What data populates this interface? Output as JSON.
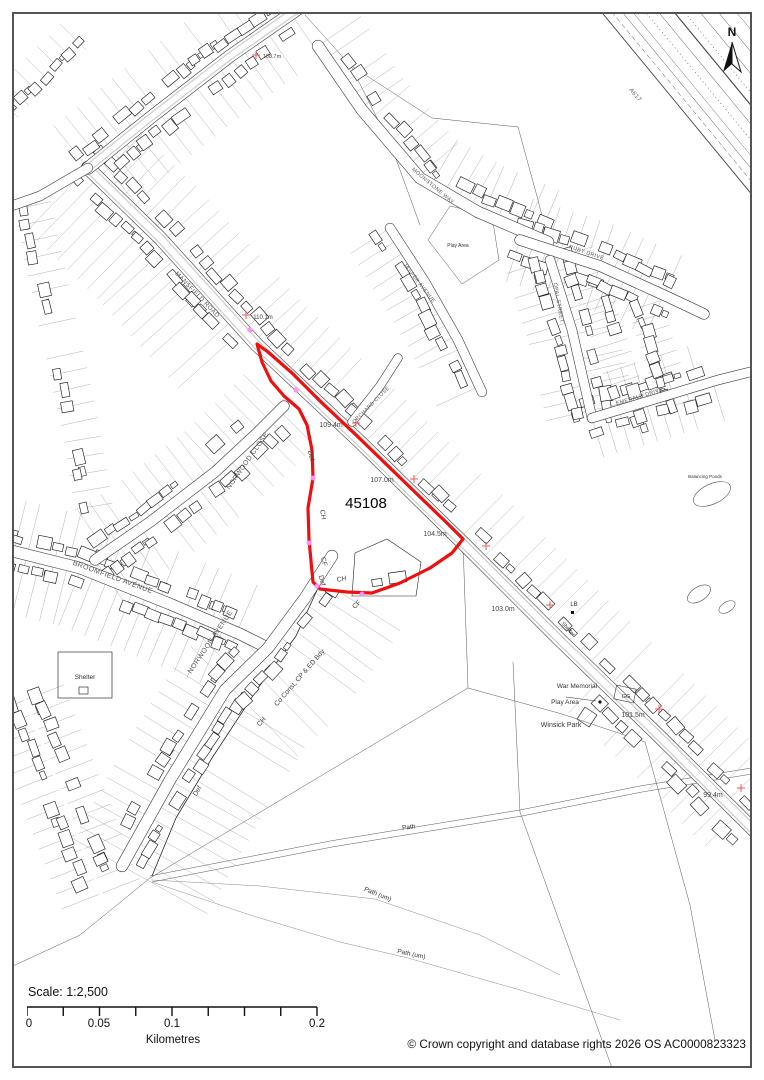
{
  "page": {
    "background": "#ffffff",
    "border_color": "#545456"
  },
  "compass": {
    "north_label": "N"
  },
  "site": {
    "ref_label": "45108",
    "boundary_color": "#ee0f0f"
  },
  "scalebar": {
    "scale_label": "Scale: 1:2,500",
    "tick_labels": [
      "0",
      "0.05",
      "0.1",
      "0.2"
    ],
    "unit_label": "Kilometres"
  },
  "footer": {
    "copyright": "© Crown copyright and database rights 2026 OS AC0000823323"
  },
  "colors": {
    "elevation_cross": "#ea5c5c",
    "boundary_marker": "#ff70ff",
    "street_text": "#555555",
    "feature_text": "#333333"
  },
  "labels": {
    "streets": [
      {
        "text": "MANSFIELD ROAD",
        "x": 196,
        "y": 296,
        "rot": 46,
        "size": 6.2
      },
      {
        "text": "ORCHARD CLOSE",
        "x": 372,
        "y": 406,
        "rot": -45,
        "size": 5.2
      },
      {
        "text": "NORWOOD CLOSE",
        "x": 249,
        "y": 462,
        "rot": -55,
        "size": 6.8
      },
      {
        "text": "BROOMFIELD AVENUE",
        "x": 112,
        "y": 579,
        "rot": 20,
        "size": 7
      },
      {
        "text": "NORWOOD AVENUE",
        "x": 212,
        "y": 643,
        "rot": -56,
        "size": 7
      },
      {
        "text": "MOONSTONE WAY",
        "x": 432,
        "y": 187,
        "rot": 40,
        "size": 5.4
      },
      {
        "text": "JASPER AVENUE",
        "x": 418,
        "y": 284,
        "rot": 52,
        "size": 5.4
      },
      {
        "text": "RUBY DRIVE",
        "x": 586,
        "y": 254,
        "rot": 19,
        "size": 5.4
      },
      {
        "text": "OPAL STREET",
        "x": 557,
        "y": 303,
        "rot": 80,
        "size": 5.4
      },
      {
        "text": "EMERALD DRIVE",
        "x": 640,
        "y": 398,
        "rot": -17,
        "size": 5.4
      },
      {
        "text": "A617",
        "x": 634,
        "y": 96,
        "rot": 50,
        "size": 6
      }
    ],
    "boundaries": [
      {
        "text": "Def",
        "x": 309,
        "y": 456,
        "rot": 78
      },
      {
        "text": "CH",
        "x": 321,
        "y": 515,
        "rot": 80
      },
      {
        "text": "CF",
        "x": 322,
        "y": 562,
        "rot": 75
      },
      {
        "text": "Def",
        "x": 320,
        "y": 581,
        "rot": 75
      },
      {
        "text": "CH",
        "x": 342,
        "y": 581,
        "rot": -10
      },
      {
        "text": "CF",
        "x": 358,
        "y": 606,
        "rot": -44
      },
      {
        "text": "Co Const, CP & ED Bdy",
        "x": 301,
        "y": 679,
        "rot": -49
      },
      {
        "text": "CH",
        "x": 263,
        "y": 723,
        "rot": -49
      },
      {
        "text": "Def",
        "x": 199,
        "y": 792,
        "rot": -58
      }
    ],
    "elevations": [
      {
        "text": "108.7m",
        "x": 272,
        "y": 58,
        "cx": 256,
        "cy": 55,
        "size": 5.5
      },
      {
        "text": "110.1m",
        "x": 263,
        "y": 319,
        "cx": 246,
        "cy": 315,
        "size": 6
      },
      {
        "text": "109.4m",
        "x": 331,
        "y": 427,
        "cx": 356,
        "cy": 423,
        "size": 7
      },
      {
        "text": "107.0m",
        "x": 382,
        "y": 482,
        "cx": 414,
        "cy": 479,
        "size": 7
      },
      {
        "text": "104.5m",
        "x": 435,
        "y": 536,
        "cx": 486,
        "cy": 546,
        "size": 7
      },
      {
        "text": "103.0m",
        "x": 503,
        "y": 611,
        "cx": 550,
        "cy": 605,
        "size": 7
      },
      {
        "text": "101.5m",
        "x": 633,
        "y": 717,
        "cx": 659,
        "cy": 709,
        "size": 7
      },
      {
        "text": "99.4m",
        "x": 713,
        "y": 797,
        "cx": 741,
        "cy": 788,
        "size": 7
      }
    ],
    "features": [
      {
        "text": "Play Area",
        "x": 458,
        "y": 247,
        "rot": 0,
        "size": 5
      },
      {
        "text": "Shelter",
        "x": 85,
        "y": 679,
        "rot": 0,
        "size": 6.5
      },
      {
        "text": "War Memorial",
        "x": 577,
        "y": 688,
        "rot": 0,
        "size": 6.5
      },
      {
        "text": "Play Area",
        "x": 565,
        "y": 704,
        "rot": 0,
        "size": 6.5
      },
      {
        "text": "Winsick Park",
        "x": 561,
        "y": 727,
        "rot": 0,
        "size": 7
      },
      {
        "text": "LB",
        "x": 574,
        "y": 606,
        "rot": 0,
        "size": 6
      },
      {
        "text": "GG",
        "x": 626,
        "y": 698,
        "rot": 0,
        "size": 5.5
      },
      {
        "text": "Balancing Ponds",
        "x": 705,
        "y": 478,
        "rot": 0,
        "size": 4.5
      },
      {
        "text": "Path",
        "x": 409,
        "y": 829,
        "rot": -8,
        "size": 6.5
      },
      {
        "text": "Path (um)",
        "x": 377,
        "y": 896,
        "rot": 22,
        "size": 6.5
      },
      {
        "text": "Path (um)",
        "x": 411,
        "y": 956,
        "rot": 12,
        "size": 6.5
      },
      {
        "text": "Shelter",
        "x": 567,
        "y": 630,
        "rot": 48,
        "size": 5.5
      }
    ]
  }
}
